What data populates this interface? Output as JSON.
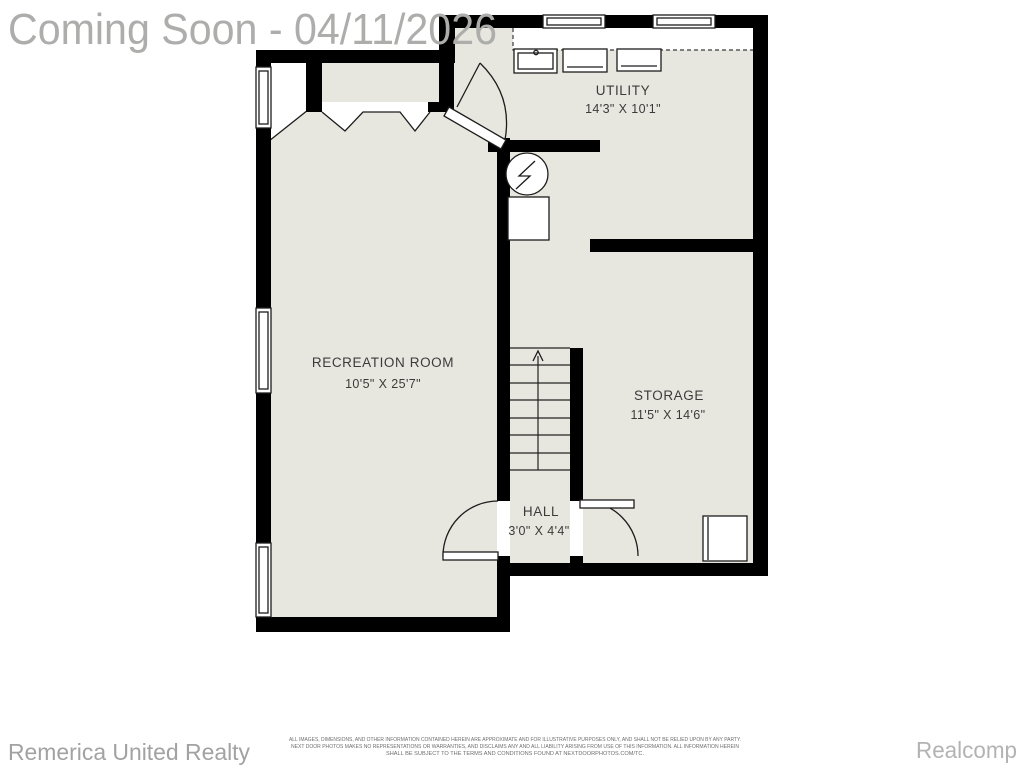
{
  "watermark": "Coming Soon - 04/11/2026",
  "rooms": {
    "utility": {
      "name": "UTILITY",
      "dims": "14'3\" X 10'1\""
    },
    "recreation": {
      "name": "RECREATION ROOM",
      "dims": "10'5\" X 25'7\""
    },
    "storage": {
      "name": "STORAGE",
      "dims": "11'5\" X 14'6\""
    },
    "hall": {
      "name": "HALL",
      "dims": "3'0\" X 4'4\""
    }
  },
  "footer": {
    "left_brand": "Remerica United Realty",
    "right_brand": "Realcomp",
    "disclaimer": [
      "ALL IMAGES, DIMENSIONS, AND OTHER INFORMATION CONTAINED HEREIN ARE APPROXIMATE AND FOR ILLUSTRATIVE PURPOSES ONLY, AND SHALL NOT BE RELIED UPON BY ANY PARTY.",
      "NEXT DOOR PHOTOS MAKES NO REPRESENTATIONS OR WARRANTIES, AND DISCLAIMS ANY AND ALL LIABILITY ARISING FROM USE OF THIS INFORMATION. ALL INFORMATION HEREIN",
      "SHALL BE SUBJECT TO THE TERMS AND CONDITIONS FOUND AT NEXTDOORPHOTOS.COM/TC."
    ]
  },
  "colors": {
    "floor": "#e8e7df",
    "wall": "#000000",
    "watermark_gray": "#adadab",
    "label_gray": "#3b3b3b",
    "brand_gray": "#a2a2a2"
  }
}
